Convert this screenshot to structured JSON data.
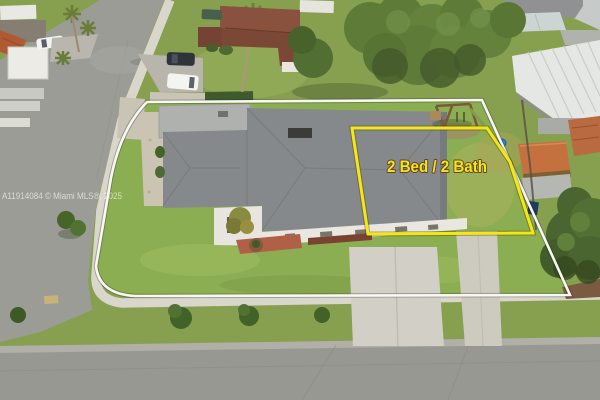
{
  "annotations": {
    "bed_bath_label": "2 Bed / 2 Bath",
    "label_color": "#f0e71e",
    "highlight_box_color": "#f5e714",
    "property_outline_color": "#f8f8f3"
  },
  "watermark": {
    "text": "A11914084 © Miami MLS®, 2025",
    "color": "#ffffff"
  },
  "palette": {
    "grass_base": "#87a050",
    "subject_lawn": "#8cae52",
    "street": "#9a9a94",
    "concrete": "#d9d6cc",
    "roof_shingle_gray": "#85898c",
    "roof_flat_gray": "#afb1ae",
    "neighbor_roof_brown": "#7c4836",
    "terracotta_roof": "#c4713f",
    "white_metal_roof": "#e4e7e4",
    "tree_green": "#5e7b38",
    "barrel_blue": "#2f80d8"
  }
}
